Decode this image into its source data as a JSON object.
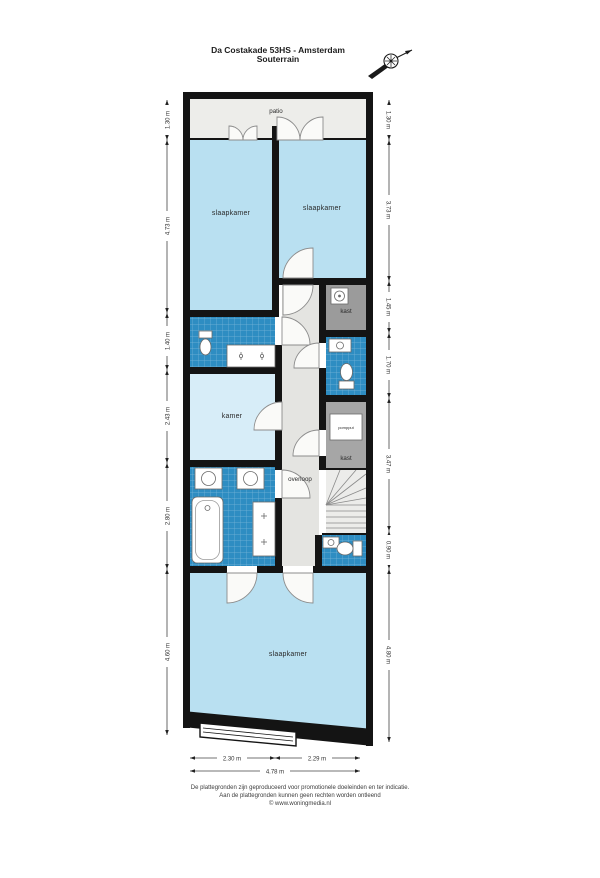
{
  "title": {
    "line1": "Da Costakade 53HS - Amsterdam",
    "line2": "Souterrain"
  },
  "rooms": {
    "patio": "patio",
    "slaapkamer_top_left": "slaapkamer",
    "slaapkamer_top_right": "slaapkamer",
    "kast_boiler": "kast",
    "kamer": "kamer",
    "pompput": "pompput",
    "kast_pump": "kast",
    "overloop": "overloop",
    "slaapkamer_bottom": "slaapkamer"
  },
  "dimensions": {
    "left": [
      "1.30 m",
      "4.73 m",
      "1.40 m",
      "2.43 m",
      "2.80 m",
      "4.60 m"
    ],
    "right": [
      "1.30 m",
      "3.73 m",
      "1.45 m",
      "1.70 m",
      "3.47 m",
      "0.90 m",
      "4.80 m"
    ],
    "bottom_segments": [
      "2.30 m",
      "2.29 m"
    ],
    "bottom_total": "4.78 m"
  },
  "footer": {
    "line1": "De plattegronden zijn geproduceerd voor promotionele doeleinden en ter indicatie.",
    "line2": "Aan de plattegronden kunnen geen rechten worden ontleend",
    "line3": "© www.woningmedia.nl"
  },
  "colors": {
    "wall": "#141414",
    "bedroom_blue": "#b9e0f1",
    "kamer_blue": "#d7edf8",
    "tile_blue": "#2e8dc2",
    "hall_gray": "#e4e4e1",
    "closet_gray": "#9b9b9b",
    "patio_gray": "#ededea"
  }
}
